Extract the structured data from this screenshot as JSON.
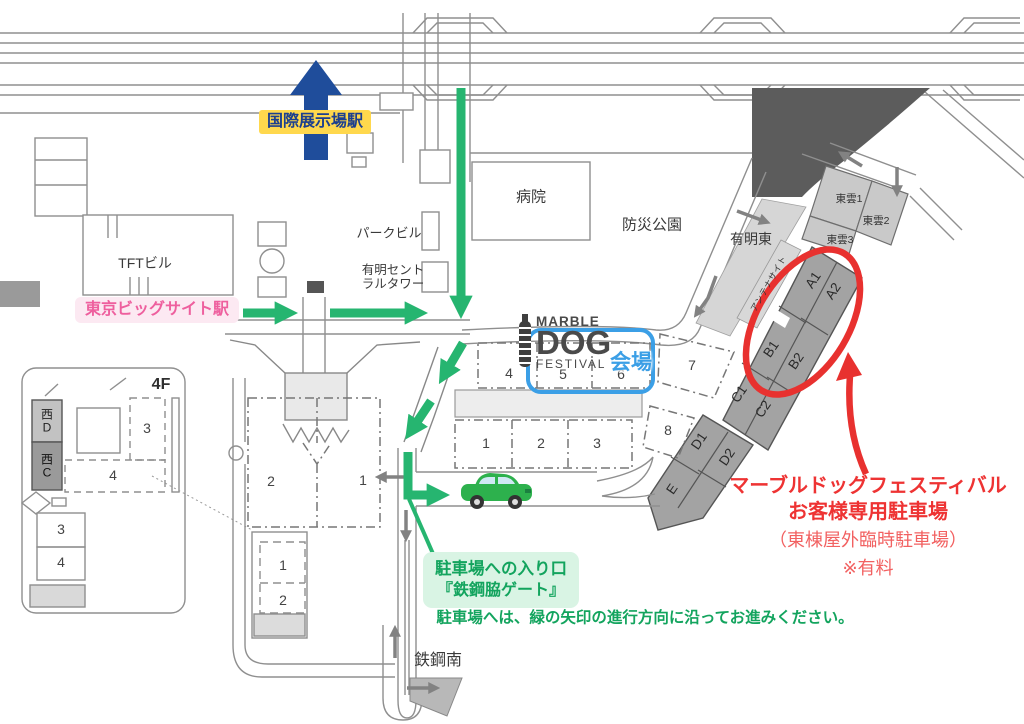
{
  "colors": {
    "route_green": "#26b570",
    "note_green": "#13a45e",
    "note_green_bg": "#d9f4e4",
    "annotation_red": "#e8312f",
    "station_yellow_bg": "#ffd84d",
    "station_blue_text": "#1c3f8f",
    "station_pink_text": "#ee5f9e",
    "station_pink_bg": "#fce9f2",
    "venue_blue": "#3b9fe6",
    "parking_gray": "#a3a3a3",
    "car_green": "#2db14d"
  },
  "stations": {
    "kokusai": "国際展示場駅",
    "bigsight": "東京ビッグサイト駅"
  },
  "logo": {
    "marble": "MARBLE",
    "dog": "DOG",
    "festival": "FESTIVAL",
    "venue": "会場"
  },
  "places": {
    "hospital": "病院",
    "bosai_park": "防災公園",
    "ariake_higashi": "有明東",
    "park_building": "パークビル",
    "ariake_central": "有明セント\nラルタワー",
    "tft_building": "TFTビル",
    "tekko_minami": "鉄鋼南",
    "floor_4f": "4F",
    "antenna_site": "アンテナサイト"
  },
  "halls": {
    "east_4": "4",
    "east_5": "5",
    "east_6": "6",
    "east_7": "7",
    "east_1": "1",
    "east_2": "2",
    "east_3": "3",
    "east_8": "8",
    "west_2": "2",
    "west_1": "1",
    "south_1": "1",
    "south_2": "2",
    "annex_upper_3": "3",
    "annex_upper_4": "4",
    "annex_lower_3": "3",
    "annex_lower_4": "4",
    "west_d": "西\nD",
    "west_c": "西\nC"
  },
  "parking": {
    "a1": "A1",
    "a2": "A2",
    "b1": "B1",
    "b2": "B2",
    "c1": "C1",
    "c2": "C2",
    "d1": "D1",
    "d2": "D2",
    "e": "E",
    "shinonome_1": "東雲1",
    "shinonome_2": "東雲2",
    "shinonome_3": "東雲3"
  },
  "notes": {
    "red_line1": "マーブルドッグフェスティバル",
    "red_line2": "お客様専用駐車場",
    "red_line3": "（東棟屋外臨時駐車場）",
    "red_line4": "※有料",
    "gate_line1": "駐車場への入り口",
    "gate_line2": "『鉄鋼脇ゲート』",
    "route_instruction": "駐車場へは、緑の矢印の進行方向に沿ってお進みください。"
  }
}
